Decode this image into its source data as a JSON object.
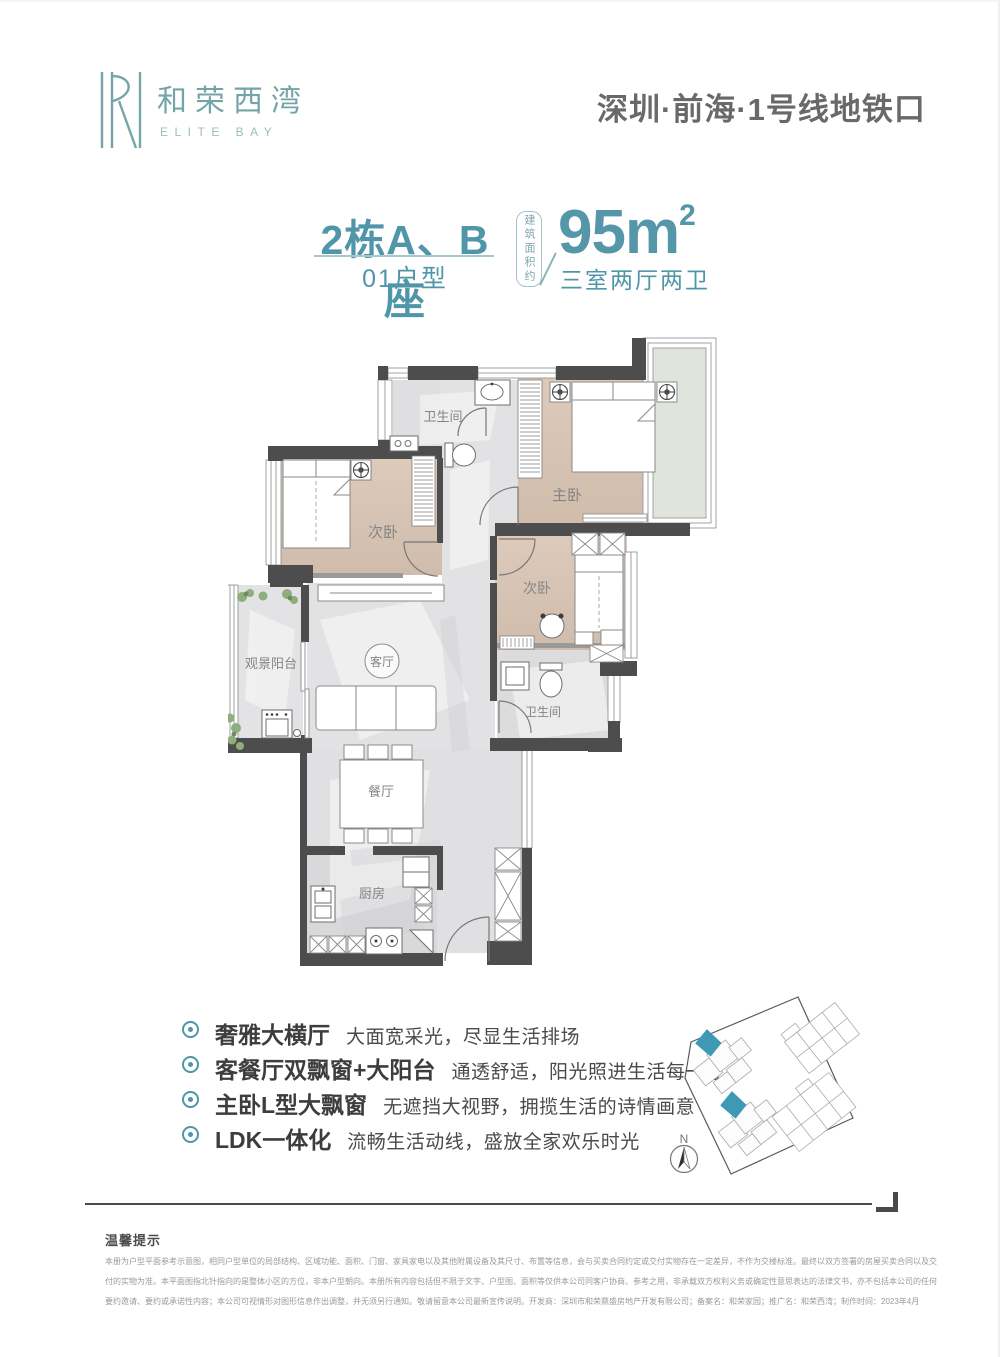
{
  "brand": {
    "name_cn": "和荣西湾",
    "name_en": "ELITE BAY"
  },
  "header": {
    "location": "深圳·前海·1号线地铁口"
  },
  "title": {
    "block": "2栋A、B座",
    "unit": "01户型",
    "area_label": "建筑面积约",
    "area_value": "95m",
    "area_sup": "2",
    "layout": "三室两厅两卫"
  },
  "floorplan": {
    "rooms": [
      "卫生间",
      "主卧",
      "次卧",
      "次卧",
      "观景阳台",
      "客厅",
      "卫生间",
      "餐厅",
      "厨房"
    ]
  },
  "features": [
    {
      "title": "奢雅大横厅",
      "desc": "大面宽采光，尽显生活排场"
    },
    {
      "title": "客餐厅双飘窗+大阳台",
      "desc": "通透舒适，阳光照进生活每一寸"
    },
    {
      "title": "主卧L型大飘窗",
      "desc": "无遮挡大视野，拥揽生活的诗情画意"
    },
    {
      "title": "LDK一体化",
      "desc": "流畅生活动线，盛放全家欢乐时光"
    }
  ],
  "sitemap": {
    "compass": "N"
  },
  "footer": {
    "notice_title": "温馨提示",
    "lines": [
      "本册为户型平面参考示意图，相同户型单位的局部结构、区域功能、面积、门窗、家具家电以及其他附属设备及其尺寸、布置等信息，会与买卖合同约定或交付实物存在一定差异，不作为交楼标准。最终以双方签署的房屋买卖合同以及交",
      "付的实物为准。本平面图指北针指向的是整体小区的方位，非本户型朝向。本册所有内容包括但不限于文字、户型图、面积等仅供本公司同客户协商、参考之用，非承载双方权利义务或确定性意思表达的法律文书，亦不包括本公司的任何",
      "要约邀请、要约或承诺性内容；本公司可视情形对图形信息作出调整，并无须另行通知。敬请留意本公司最新宣传说明。开发商：深圳市和荣鼎盛房地产开发有限公司；备案名：和荣家园；推广名：和荣西湾；制作时间：2023年4月"
    ]
  },
  "colors": {
    "accent_teal": "#4f96a8",
    "logo_teal": "#73a5a8",
    "sitemap_highlight": "#3e9ab4",
    "wall_dark": "#4d4d4d",
    "wood_floor": "#d8c5b4",
    "marble_floor": "#e2e2e4",
    "bay_glass": "#dfe5dc"
  }
}
